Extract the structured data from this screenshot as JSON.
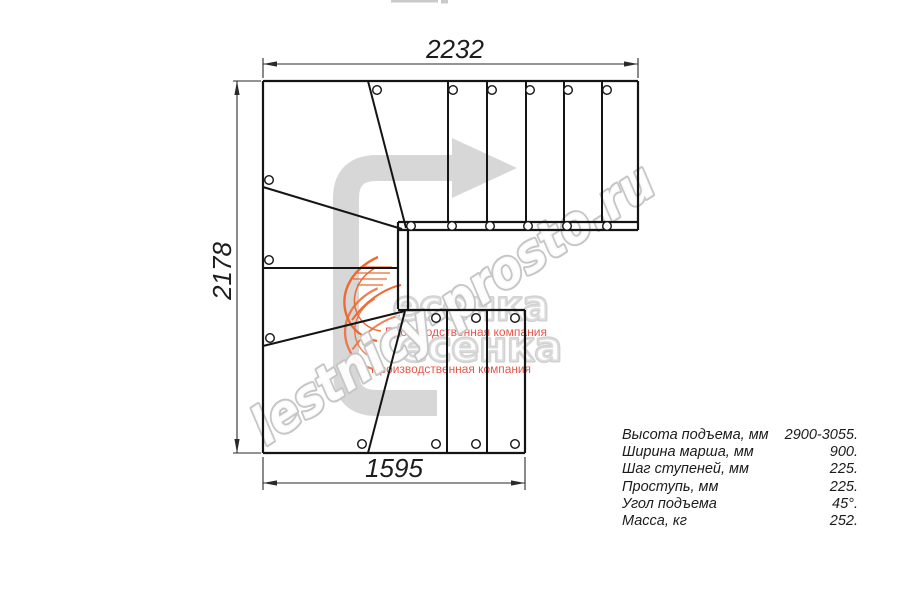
{
  "dimensions": {
    "top": "2232",
    "left": "2178",
    "bottom": "1595"
  },
  "specs": {
    "rows": [
      {
        "label": "Высота подъема, мм",
        "value": "2900-3055."
      },
      {
        "label": "Ширина марша, мм",
        "value": "900."
      },
      {
        "label": "Шаг ступеней, мм",
        "value": "225."
      },
      {
        "label": "Проступь, мм",
        "value": "225."
      },
      {
        "label": "Угол подъема",
        "value": "45°."
      },
      {
        "label": "Масса, кг",
        "value": "252."
      }
    ]
  },
  "watermark": {
    "site": "lestnicy-prosto.ru",
    "logo": "есенка",
    "tagline": "Производственная компания",
    "colors": {
      "site_outline": "#c6c6c6",
      "logo_outline": "#d2d2d2",
      "tagline_red": "#e23a2b",
      "swoosh_orange": "#ee6a32",
      "arrow_gray": "#d7d7d7",
      "line_black": "#141414"
    }
  }
}
